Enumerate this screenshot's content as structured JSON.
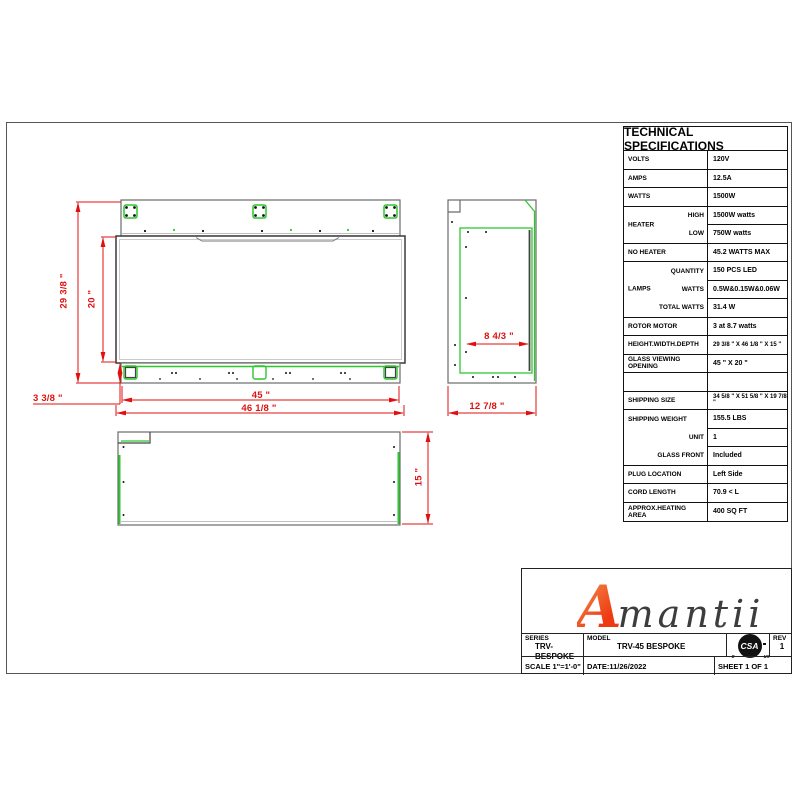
{
  "drawing": {
    "front_view": {
      "overall_height": "29 3/8 \"",
      "viewing_height": "20 \"",
      "base_height": "3 3/8 \"",
      "viewing_width": "45 \"",
      "overall_width": "46 1/8 \""
    },
    "side_view": {
      "glass_inset_depth": "8 4/3 \"",
      "overall_depth": "12 7/8 \""
    },
    "plan_view": {
      "depth": "15 \""
    }
  },
  "spec_table": {
    "title": "TECHNICAL SPECIFICATIONS",
    "rows": [
      {
        "label": "VOLTS",
        "value": "120V"
      },
      {
        "label": "AMPS",
        "value": "12.5A"
      },
      {
        "label": "WATTS",
        "value": "1500W"
      },
      {
        "group": "HEATER",
        "sub": [
          {
            "label": "HIGH",
            "value": "1500W watts"
          },
          {
            "label": "LOW",
            "value": "750W watts"
          }
        ]
      },
      {
        "label": "NO HEATER",
        "value": "45.2 WATTS MAX"
      },
      {
        "group": "LAMPS",
        "sub": [
          {
            "label": "QUANTITY",
            "value": "150 PCS LED"
          },
          {
            "label": "WATTS",
            "value": "0.5W&0.15W&0.06W"
          },
          {
            "label": "TOTAL WATTS",
            "value": "31.4 W"
          }
        ]
      },
      {
        "label": "ROTOR MOTOR",
        "value": "3 at 8.7 watts"
      },
      {
        "label": "HEIGHT.WIDTH.DEPTH",
        "value": "29 3/8 \" X 46 1/8 \" X 15 \""
      },
      {
        "label": "GLASS VIEWING OPENING",
        "value": "45 \"  X 20 \""
      },
      {
        "label": "",
        "value": ""
      },
      {
        "label": "SHIPPING SIZE",
        "value": "34 5/8 \" X 51 5/8 \" X 19 7/8 \""
      },
      {
        "group": "",
        "sub": [
          {
            "label": "SHIPPING WEIGHT",
            "value": "155.5 LBS"
          },
          {
            "label": "UNIT",
            "value": "1"
          },
          {
            "label": "GLASS FRONT",
            "value": "Included"
          }
        ]
      },
      {
        "label": "PLUG LOCATION",
        "value": "Left Side"
      },
      {
        "label": "CORD LENGTH",
        "value": "70.9 < L"
      },
      {
        "label": "APPROX.HEATING AREA",
        "value": "400 SQ FT"
      }
    ]
  },
  "title_block": {
    "logo_first": "A",
    "logo_rest": "mantii",
    "series_label": "SERIES",
    "series_value": "TRV-BESPOKE",
    "model_label": "MODEL",
    "model_value": "TRV-45 BESPOKE",
    "csa_mark": "CSA",
    "csa_c": "c",
    "csa_us": "us",
    "rev_label": "REV",
    "rev_value": "1",
    "scale": "SCALE 1\"=1'-0\"",
    "date": "DATE:11/26/2022",
    "sheet": "SHEET 1 OF 1"
  },
  "colors": {
    "dimension_red": "#e01010",
    "drawing_green": "#2fc62f",
    "outline_gray": "#6b6b6b",
    "logo_orange": "#ee3a12"
  }
}
